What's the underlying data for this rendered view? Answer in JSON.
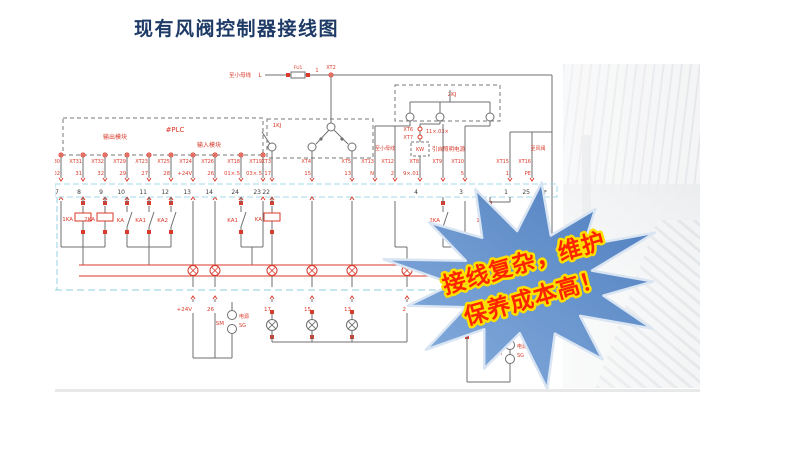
{
  "title": "现有风阀控制器接线图",
  "callout": {
    "line1": "接线复杂，维护",
    "line2": "保养成本高！"
  },
  "colors": {
    "title_navy": "#1e3a66",
    "diagram_red": "#d93a2b",
    "diagram_gray": "#6f6f6f",
    "strip_cyan": "#a5d8e8",
    "star_fill_light": "#85aede",
    "star_fill_dark": "#4e7dbe",
    "star_stroke": "#d9e5f3",
    "star_text_red": "#ff2400",
    "star_text_glow": "#ffdf00"
  },
  "diagram": {
    "top_bus": {
      "feeder_label": "至小母线",
      "phase": "L",
      "fuse": "FU1",
      "wire": "1",
      "terminal": "XT2"
    },
    "plc": {
      "left_label": "输出模块",
      "name": "#PLC",
      "right_label": "输入模块"
    },
    "plc_columns": [
      {
        "xt": "XT30",
        "wire": "N02",
        "strip": "7"
      },
      {
        "xt": "XT31",
        "wire": "31",
        "strip": "8"
      },
      {
        "xt": "XT32",
        "wire": "32",
        "strip": "9"
      },
      {
        "xt": "XT29",
        "wire": "29",
        "strip": "10"
      },
      {
        "xt": "XT23",
        "wire": "27",
        "strip": "11"
      },
      {
        "xt": "XT25",
        "wire": "28",
        "strip": "12"
      },
      {
        "xt": "XT24",
        "wire": "+24V",
        "strip": "13"
      },
      {
        "xt": "XT26",
        "wire": "26",
        "strip": "14"
      },
      {
        "xt": "XT18",
        "wire": "01×.5",
        "strip": "24"
      },
      {
        "xt": "XT19",
        "wire": "03×.5",
        "strip": "23"
      }
    ],
    "kj1": {
      "name": "1KJ",
      "columns": [
        {
          "xt": "XT3",
          "wire": "17",
          "strip": "22"
        },
        {
          "xt": "XT4",
          "wire": "15",
          "strip": ""
        },
        {
          "xt": "XT5",
          "wire": "13",
          "strip": ""
        }
      ]
    },
    "kj2": {
      "name": "2KJ",
      "feeder_label": "至小母线",
      "aux": [
        {
          "xt": "XT6"
        },
        {
          "xt": "XT7"
        }
      ],
      "aux_wire": "11×.03×",
      "kw": "KW",
      "kw_note": "引自照明电源",
      "columns": [
        {
          "xt": "XT13",
          "wire": "N",
          "strip": ""
        },
        {
          "xt": "XT12",
          "wire": "2",
          "strip": ""
        },
        {
          "xt": "XT8",
          "wire": "9×.01",
          "strip": "4"
        },
        {
          "xt": "XT9",
          "wire": "",
          "strip": ""
        },
        {
          "xt": "XT10",
          "wire": "5",
          "strip": "3"
        }
      ]
    },
    "outgoing": {
      "label": "至风阀",
      "columns": [
        {
          "xt": "XT15",
          "wire": "1",
          "strip": "1"
        },
        {
          "xt": "XT16",
          "wire": "PE",
          "strip": "25"
        }
      ]
    },
    "relays": [
      "1KA",
      "2KA",
      "KA",
      "KA1",
      "KA2",
      "KA1",
      "KA",
      "2KA",
      "1KA"
    ],
    "bottom_wires": [
      "+24V",
      "26",
      "17",
      "15",
      "13",
      "2"
    ],
    "psu": {
      "name": "SM",
      "note1": "电源",
      "note2": "SG"
    }
  }
}
